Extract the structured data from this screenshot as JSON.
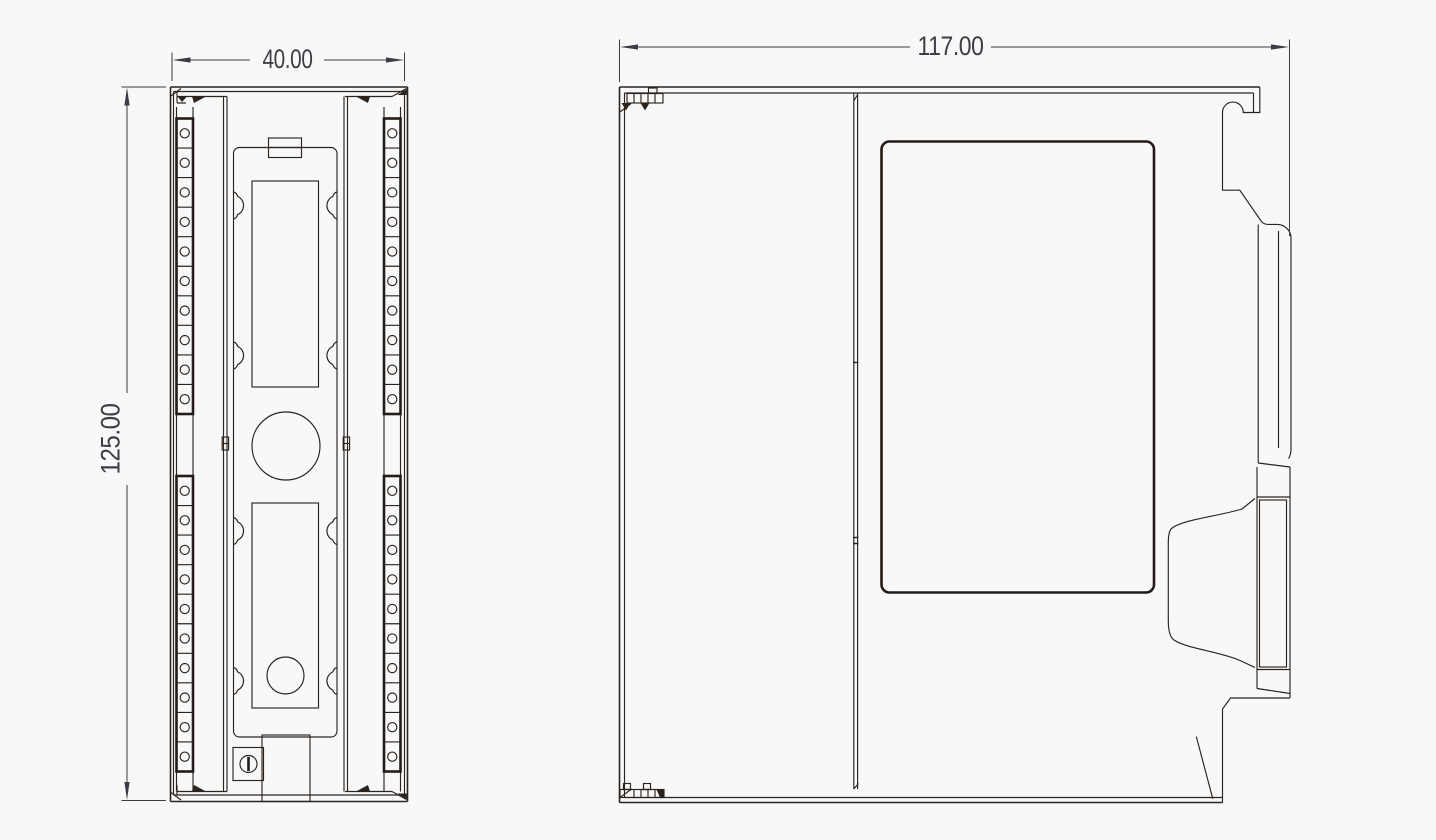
{
  "drawing": {
    "type": "technical-2d-cad-drawing",
    "subject": "DIN-rail mounted PLC I/O module, dimensioned outline drawing",
    "units_shown": false,
    "views": {
      "front": {
        "label": "front-view",
        "terminal_strips": {
          "sides": 2,
          "groups_per_side": 2,
          "terminals_per_group": 10
        },
        "features": [
          "top-clip-tab",
          "upper-window",
          "center-circle",
          "lower-window",
          "small-circle",
          "screw-head",
          "bottom-tab",
          "edge-cutouts"
        ]
      },
      "side": {
        "label": "side-view",
        "features": [
          "front-cover-seam",
          "label-plate",
          "din-rail-latch",
          "connector-bulge",
          "top-hinge",
          "bottom-hinge"
        ]
      }
    },
    "dimensions": {
      "front_width": {
        "value": "40.00",
        "orientation": "horizontal",
        "applies_to": "front-view"
      },
      "front_height": {
        "value": "125.00",
        "orientation": "vertical",
        "applies_to": "front-view"
      },
      "side_width": {
        "value": "117.00",
        "orientation": "horizontal",
        "applies_to": "side-view"
      }
    },
    "colors": {
      "background": "#f8f8f8",
      "line": "#2b231e",
      "dimension_text": "#3d3d46",
      "dimension_line": "#3c3c44"
    }
  }
}
